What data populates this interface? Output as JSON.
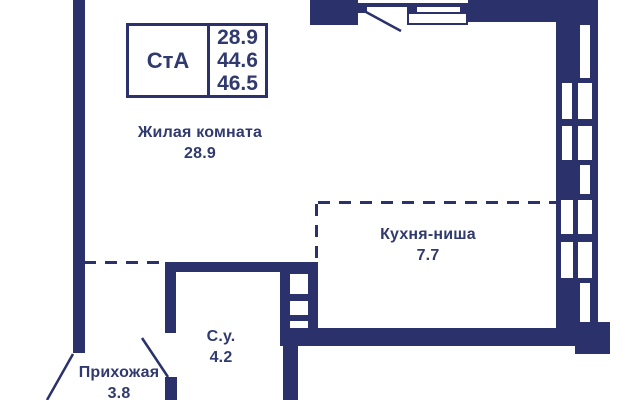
{
  "colors": {
    "wall": "#2a316b",
    "text": "#303a6e",
    "background": "#ffffff"
  },
  "legend": {
    "type": "СтА",
    "values": [
      "28.9",
      "44.6",
      "46.5"
    ]
  },
  "rooms": [
    {
      "name": "Жилая комната",
      "area": "28.9"
    },
    {
      "name": "Кухня-ниша",
      "area": "7.7"
    },
    {
      "name": "С.у.",
      "area": "4.2"
    },
    {
      "name": "Прихожая",
      "area": "3.8"
    }
  ]
}
